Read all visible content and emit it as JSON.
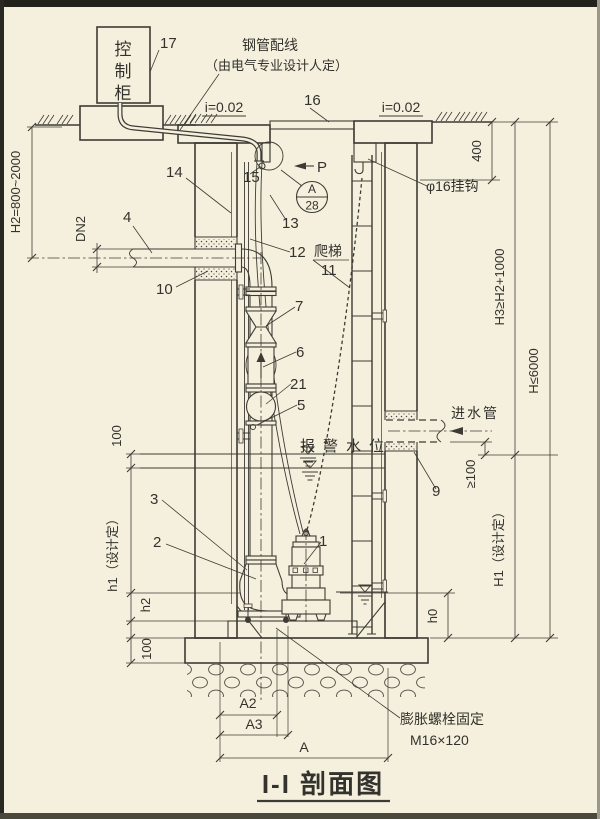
{
  "drawing": {
    "title": "I-I 剖面图"
  },
  "cabinet": {
    "chars": [
      "控",
      "制",
      "柜"
    ],
    "ref": "17"
  },
  "conduit": {
    "note1": "钢管配线",
    "note2": "（由电气专业设计人定）",
    "ref": "15"
  },
  "ground": {
    "slope_left": "i=0.02",
    "slope_right": "i=0.02"
  },
  "cover": {
    "ref": "16"
  },
  "vent": {
    "label": "P"
  },
  "detail": {
    "letter": "A",
    "sheet": "28"
  },
  "hook": {
    "label": "φ16挂钩"
  },
  "labels": {
    "alarm_level": "报警水位",
    "inlet_pipe": "进水管",
    "ladder": "爬梯"
  },
  "anchor_note": {
    "line1": "膨胀螺栓固定",
    "line2": "M16×120"
  },
  "dims": {
    "d400": "400",
    "h3": "H3≥H2+1000",
    "h_total": "H≤6000",
    "h1_right": "H1（设计定）",
    "ge100": "≥100",
    "h0": "h0",
    "h2_left": "H2=800~2000",
    "dn2": "DN2",
    "n100_upper": "100",
    "h1_left": "h1（设计定）",
    "h2_small": "h2",
    "n100_lower": "100",
    "a2": "A2",
    "a3": "A3",
    "a": "A"
  },
  "refs": {
    "pump": "1",
    "discharge_elbow": "2",
    "coupling": "3",
    "outlet_pipe": "4",
    "riser_pipe": "5",
    "check_valve": "6",
    "gate_valve": "7",
    "inlet_sleeve": "9",
    "outlet_sleeve": "10",
    "ladder": "11",
    "guide_rail": "12",
    "cable": "13",
    "liner": "14",
    "conduit_outlet": "15",
    "cover": "16",
    "cabinet": "17",
    "flex_joint": "21"
  }
}
